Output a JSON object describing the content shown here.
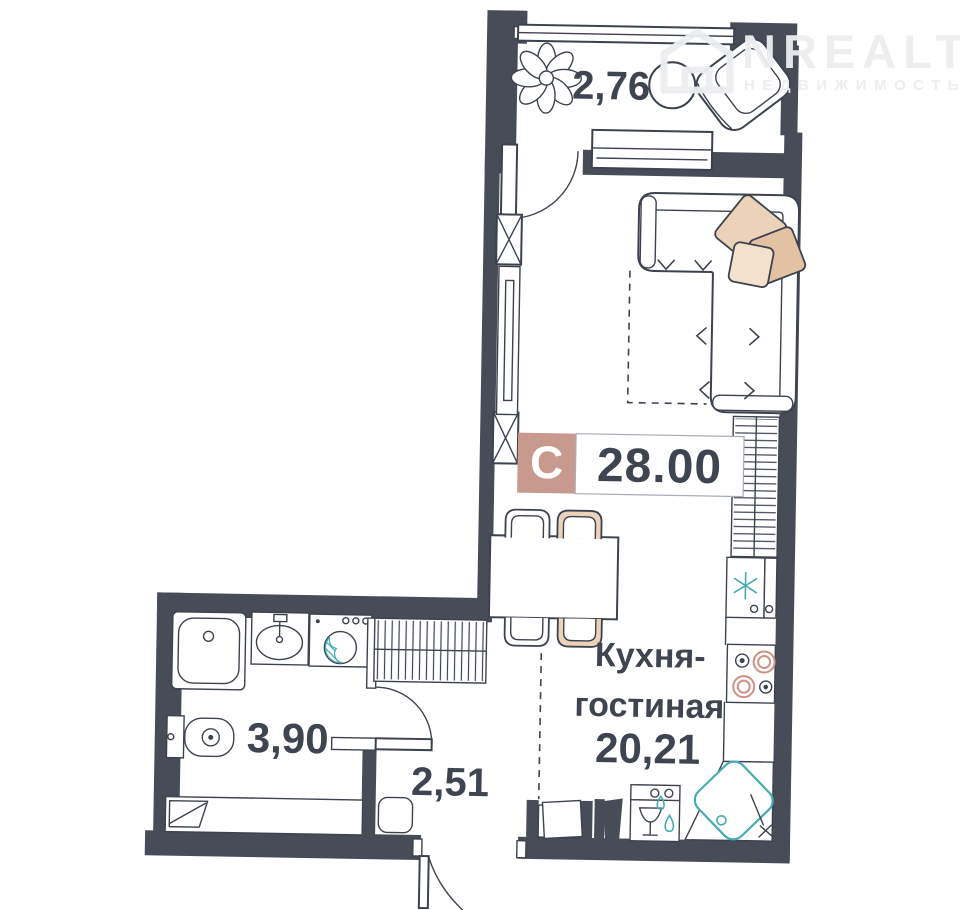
{
  "watermark": {
    "brand": "NREALT",
    "subtitle": "НЕДВИЖИМОСТЬ"
  },
  "plan": {
    "flat_type_badge": "С",
    "total_area": "28.00",
    "rooms": {
      "balcony": {
        "area": "2,76"
      },
      "kitchen_living": {
        "name_line1": "Кухня-",
        "name_line2": "гостиная",
        "area": "20,21"
      },
      "bathroom": {
        "area": "3,90"
      },
      "hallway": {
        "area": "2,51"
      }
    }
  },
  "colors": {
    "wall": "#474c57",
    "line": "#3d434e",
    "badge_bg": "#c89a8d",
    "accent_rose": "#cf9186",
    "accent_tan": "#ecd2b8",
    "accent_teal": "#47abb4",
    "label_text": "#3f4550",
    "watermark": "#eceef0"
  }
}
